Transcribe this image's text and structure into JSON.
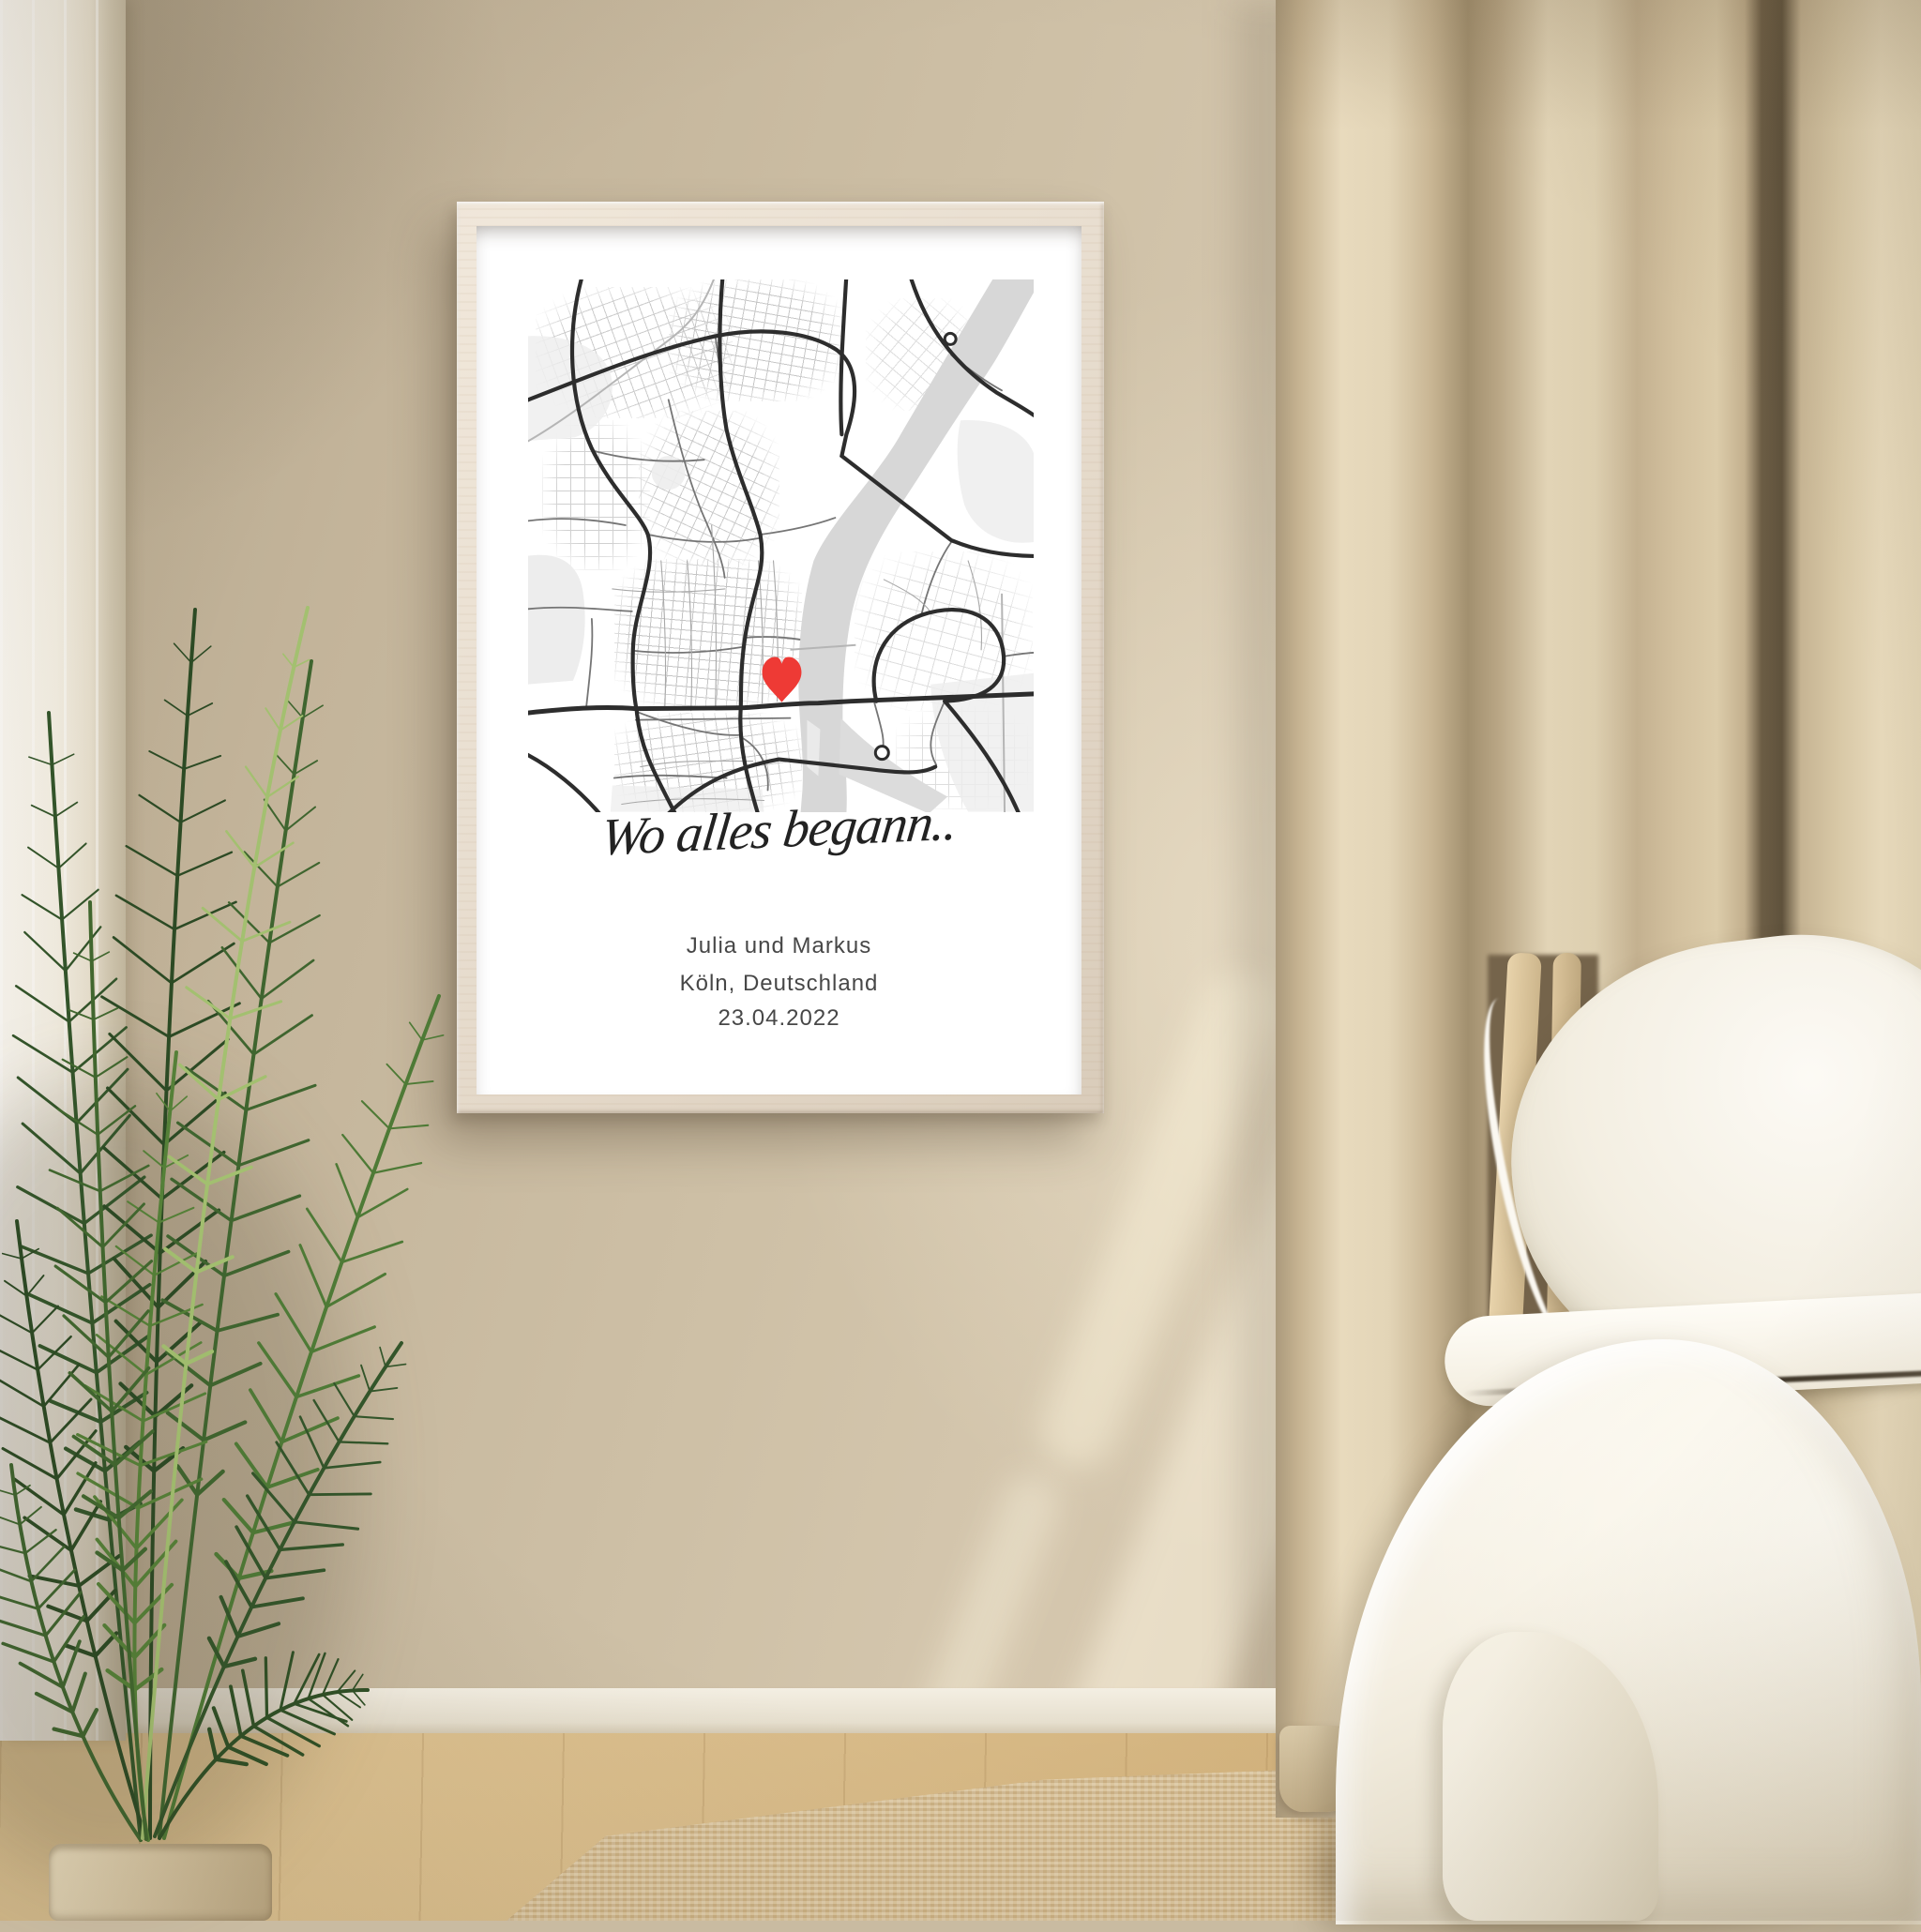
{
  "poster": {
    "title": "Wo alles begann..",
    "names": "Julia und Markus",
    "location": "Köln, Deutschland",
    "date": "23.04.2022",
    "marker": {
      "icon": "heart-icon",
      "color": "#ee3a35"
    },
    "map_style": {
      "background": "#ffffff",
      "river": "#d7d7d7",
      "park": "#ededed",
      "major_road": "#2d2d2d",
      "medium_road": "#757575",
      "minor_road": "#c6c6c6"
    }
  },
  "scene": {
    "wall_color": "#cdbfa5",
    "frame_wood_color": "#e9dfd1",
    "curtain_right_color": "#d8c7a6",
    "curtain_left_color": "#f4efe3",
    "baseboard_color": "#f4efe3",
    "floor_color": "#d9bc8a",
    "rug_color": "#d3bc93",
    "plant_leaf_color": "#3f652f",
    "plant_pot_color": "#d9c8a5",
    "bedding_color": "#f3eede"
  }
}
